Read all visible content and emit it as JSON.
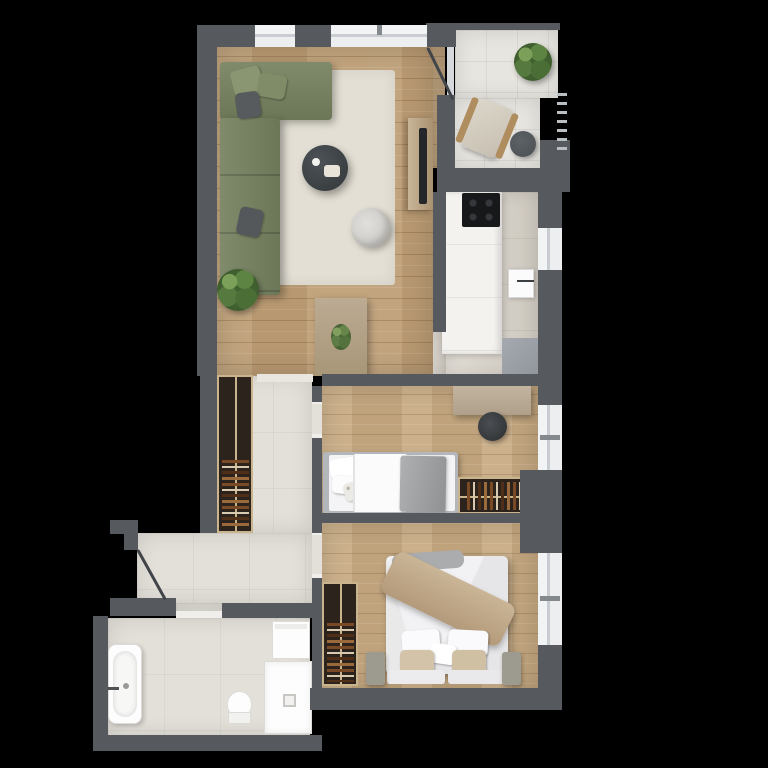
{
  "scene": {
    "title": "Apartment floor plan – top-down 3D render",
    "background_color": "#000000",
    "wall_color": "#565a5f",
    "window_color": "#f2f3f5",
    "wood_floor_color": "#bfa078",
    "tile_floor_color": "#e3e0d9"
  },
  "rooms": {
    "living_room": {
      "label": "Living room with dining area",
      "floor": "wood planks",
      "furniture": [
        "corner sofa (green)",
        "rug",
        "round coffee table",
        "pouf chair",
        "potted plant",
        "TV sideboard with TV",
        "dining table",
        "4 dining chairs"
      ]
    },
    "balcony": {
      "label": "Balcony",
      "floor": "large tiles",
      "furniture": [
        "armchair",
        "round side table",
        "potted plant",
        "railing"
      ]
    },
    "kitchen": {
      "label": "Kitchen",
      "floor": "stone tiles",
      "furniture": [
        "countertop",
        "cooktop",
        "door panel with handle",
        "cabinet"
      ]
    },
    "bedroom_small": {
      "label": "Small bedroom",
      "floor": "wood planks",
      "furniture": [
        "single bed",
        "desk",
        "desk chair",
        "open wardrobe with clothes"
      ]
    },
    "bedroom_master": {
      "label": "Master bedroom",
      "floor": "wood planks",
      "furniture": [
        "double bed with beige throw",
        "two foot benches",
        "open wardrobe with clothes"
      ]
    },
    "hallway": {
      "label": "Hallway / entry",
      "floor": "tiles",
      "furniture": [
        "open wardrobe with clothes",
        "entry door"
      ]
    },
    "bathroom": {
      "label": "Bathroom",
      "floor": "tiles",
      "furniture": [
        "bathtub",
        "toilet",
        "shower",
        "washing machine"
      ]
    }
  },
  "colors": {
    "sofa_green": "#75815f",
    "rug_beige": "#e3dfd4",
    "coffee_table_dark": "#43484b",
    "dining_wood": "#b4a38c",
    "wardrobe_frame": "#c9b48e",
    "wardrobe_interior": "#2c241c",
    "bedding_white": "#f2f2f4",
    "throw_beige": "#c3ae92",
    "blanket_gray": "#9fa2a4",
    "fixture_white": "#fdfdfd",
    "cooktop_black": "#17181a",
    "cabinet_gray": "#9aa0a5"
  }
}
